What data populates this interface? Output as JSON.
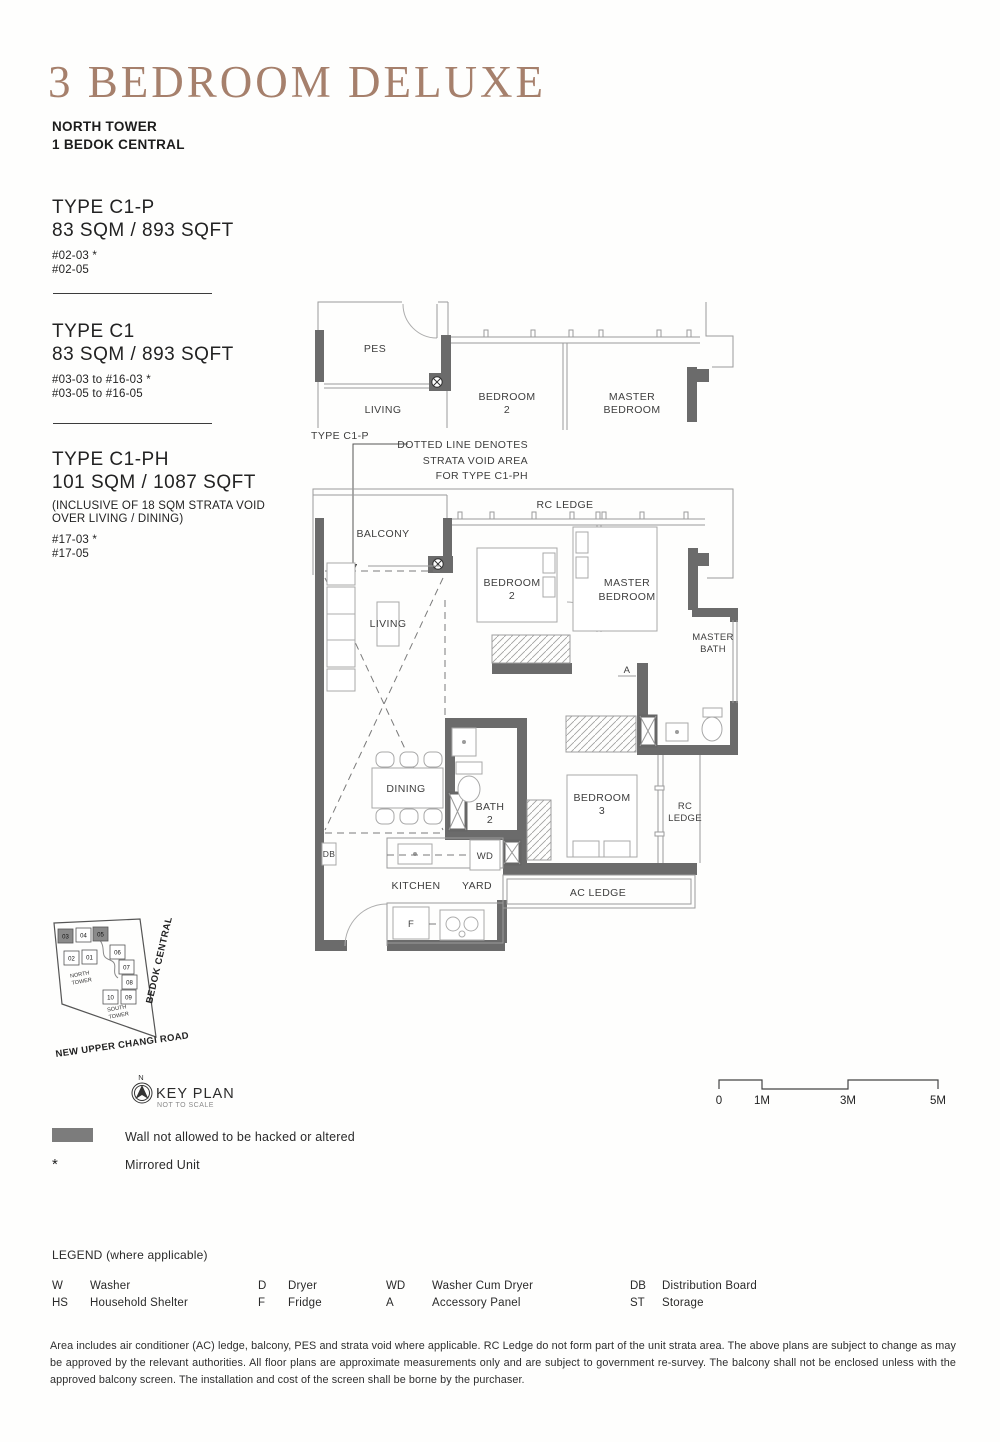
{
  "header": {
    "title": "3 BEDROOM DELUXE",
    "tower": "NORTH TOWER",
    "address": "1 BEDOK CENTRAL"
  },
  "unit_types": [
    {
      "name": "TYPE C1-P",
      "area": "83 SQM / 893 SQFT",
      "units": [
        "#02-03 *",
        "#02-05"
      ]
    },
    {
      "name": "TYPE C1",
      "area": "83 SQM / 893 SQFT",
      "units": [
        "#03-03 to #16-03 *",
        "#03-05 to #16-05"
      ]
    },
    {
      "name": "TYPE C1-PH",
      "area": "101 SQM / 1087 SQFT",
      "note_l1": "(INCLUSIVE OF 18 SQM STRATA VOID",
      "note_l2": "OVER LIVING / DINING)",
      "units": [
        "#17-03 *",
        "#17-05"
      ]
    }
  ],
  "annotation": {
    "l1": "DOTTED LINE DENOTES",
    "l2": "STRATA VOID AREA",
    "l3": "FOR TYPE C1-PH"
  },
  "plan_top": {
    "type_label": "TYPE C1-P",
    "pes": "PES",
    "living": "LIVING",
    "bedroom2_l1": "BEDROOM",
    "bedroom2_l2": "2",
    "master_l1": "MASTER",
    "master_l2": "BEDROOM"
  },
  "plan_main": {
    "rc_ledge_top": "RC LEDGE",
    "balcony": "BALCONY",
    "living": "LIVING",
    "bedroom2_l1": "BEDROOM",
    "bedroom2_l2": "2",
    "master_l1": "MASTER",
    "master_l2": "BEDROOM",
    "master_bath_l1": "MASTER",
    "master_bath_l2": "BATH",
    "accessory": "A",
    "dining": "DINING",
    "bath2_l1": "BATH",
    "bath2_l2": "2",
    "bedroom3_l1": "BEDROOM",
    "bedroom3_l2": "3",
    "rc_ledge_right_l1": "RC",
    "rc_ledge_right_l2": "LEDGE",
    "db": "DB",
    "wd": "WD",
    "fridge": "F",
    "kitchen": "KITCHEN",
    "yard": "YARD",
    "ac_ledge": "AC LEDGE"
  },
  "key_plan": {
    "title": "KEY PLAN",
    "subtitle": "NOT TO SCALE",
    "north": "N",
    "road_right": "BEDOK CENTRAL",
    "road_bottom": "NEW UPPER CHANGI ROAD",
    "north_tower_l1": "NORTH",
    "north_tower_l2": "TOWER",
    "south_tower_l1": "SOUTH",
    "south_tower_l2": "TOWER",
    "units": [
      "03",
      "04",
      "05",
      "02",
      "01",
      "06",
      "07",
      "08",
      "09",
      "10"
    ]
  },
  "scale_bar": {
    "labels": [
      "0",
      "1M",
      "3M",
      "5M"
    ]
  },
  "wall_legend": {
    "wall_label": "Wall not allowed to be hacked or altered",
    "mirror_symbol": "*",
    "mirror_label": "Mirrored Unit"
  },
  "legend": {
    "title": "LEGEND (where applicable)",
    "items": [
      {
        "key": "W",
        "label": "Washer"
      },
      {
        "key": "HS",
        "label": "Household Shelter"
      },
      {
        "key": "D",
        "label": "Dryer"
      },
      {
        "key": "F",
        "label": "Fridge"
      },
      {
        "key": "WD",
        "label": "Washer Cum Dryer"
      },
      {
        "key": "A",
        "label": "Accessory Panel"
      },
      {
        "key": "DB",
        "label": "Distribution Board"
      },
      {
        "key": "ST",
        "label": "Storage"
      }
    ]
  },
  "disclaimer": "Area includes air conditioner (AC) ledge, balcony, PES and strata void where applicable. RC Ledge do not form part of the unit strata area. The above plans are subject to change as may be approved by the relevant authorities. All floor plans are approximate measurements only and are subject to government re-survey. The balcony shall not be enclosed unless with the approved balcony screen. The installation and cost of the screen shall be borne by the purchaser.",
  "colors": {
    "accent": "#a6806c",
    "wall": "#6b6b6b"
  }
}
